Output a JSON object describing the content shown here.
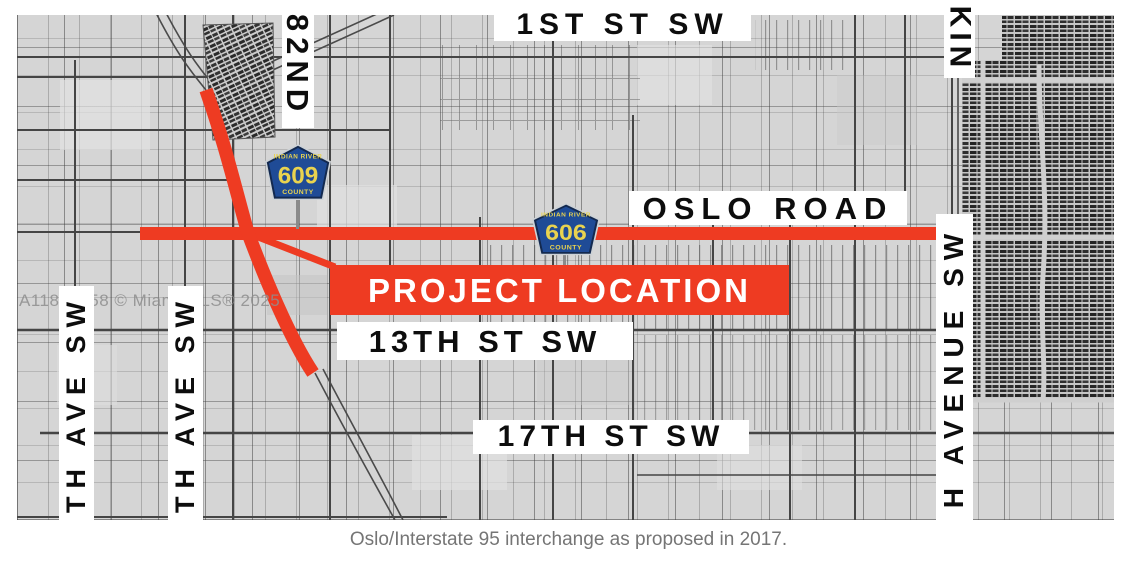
{
  "watermark": "A11808958 © Miami MLS® 2025",
  "caption": "Oslo/Interstate 95 interchange as proposed in 2017.",
  "labels": {
    "first_st_sw": "1ST ST SW",
    "eighty_second": "82ND",
    "kings": "KIN",
    "oslo_road": "OSLO ROAD",
    "project_location": "PROJECT LOCATION",
    "thirteenth_st_sw": "13TH ST SW",
    "seventeenth_st_sw": "17TH ST SW",
    "left_avenue_1": "TH AVE SW",
    "left_avenue_2": "TH AVE SW",
    "right_avenue": "H AVENUE SW"
  },
  "shields": {
    "cr609": {
      "top": "INDIAN RIVER",
      "number": "609",
      "bottom": "COUNTY"
    },
    "cr606": {
      "top": "INDIAN RIVER",
      "number": "606",
      "bottom": "COUNTY"
    }
  },
  "colors": {
    "highlight_red": "#ee3b22",
    "shield_blue": "#1f4b96",
    "shield_border": "#13294f",
    "shield_yellow": "#e9d34f",
    "map_background": "#d5d5d5",
    "caption_text": "#757575"
  }
}
